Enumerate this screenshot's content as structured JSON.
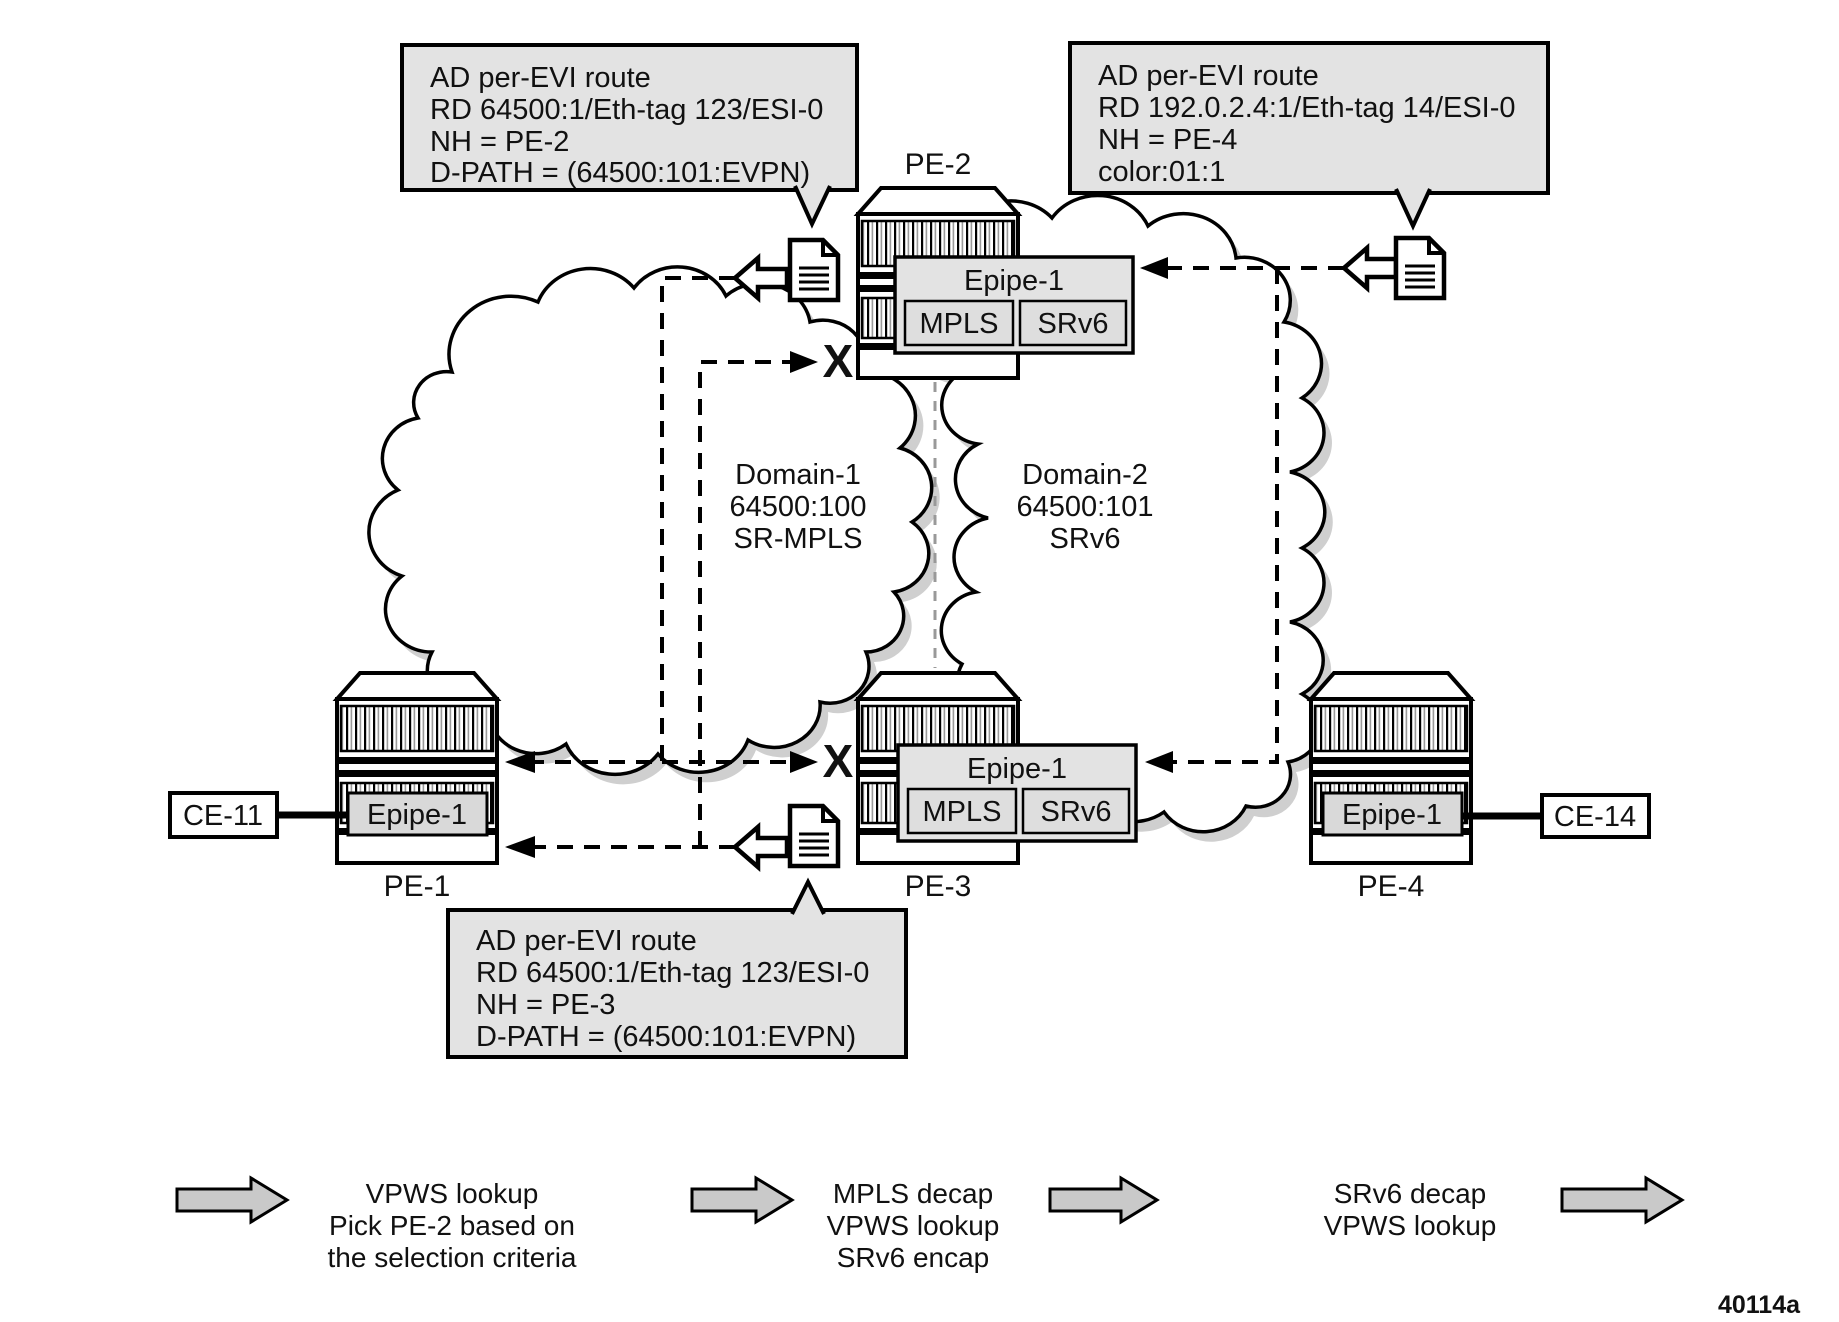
{
  "figure": {
    "id": "40114a"
  },
  "nodes": {
    "pe1": "PE-1",
    "pe2": "PE-2",
    "pe3": "PE-3",
    "pe4": "PE-4",
    "ce11": "CE-11",
    "ce14": "CE-14"
  },
  "service": {
    "epipe": "Epipe-1",
    "mpls": "MPLS",
    "srv6": "SRv6"
  },
  "domains": {
    "d1": {
      "name": "Domain-1",
      "id": "64500:100",
      "transport": "SR-MPLS"
    },
    "d2": {
      "name": "Domain-2",
      "id": "64500:101",
      "transport": "SRv6"
    }
  },
  "reject": "X",
  "callouts": {
    "pe2_route": {
      "lines": [
        "AD per-EVI route",
        "RD 64500:1/Eth-tag 123/ESI-0",
        "NH = PE-2",
        "D-PATH = (64500:101:EVPN)"
      ]
    },
    "pe4_route": {
      "lines": [
        "AD per-EVI route",
        "RD 192.0.2.4:1/Eth-tag 14/ESI-0",
        "NH = PE-4",
        "color:01:1"
      ]
    },
    "pe3_route": {
      "lines": [
        "AD per-EVI route",
        "RD 64500:1/Eth-tag 123/ESI-0",
        "NH = PE-3",
        "D-PATH = (64500:101:EVPN)"
      ]
    }
  },
  "legend": {
    "step1": [
      "VPWS lookup",
      "Pick PE-2 based on",
      "the selection criteria"
    ],
    "step2": [
      "MPLS decap",
      "VPWS lookup",
      "SRv6 encap"
    ],
    "step3": [
      "SRv6 decap",
      "VPWS lookup"
    ]
  },
  "colors": {
    "box_gray": "#e3e3e3",
    "arrow_gray": "#c9c9c9",
    "shadow_gray": "#cfcfcf"
  }
}
